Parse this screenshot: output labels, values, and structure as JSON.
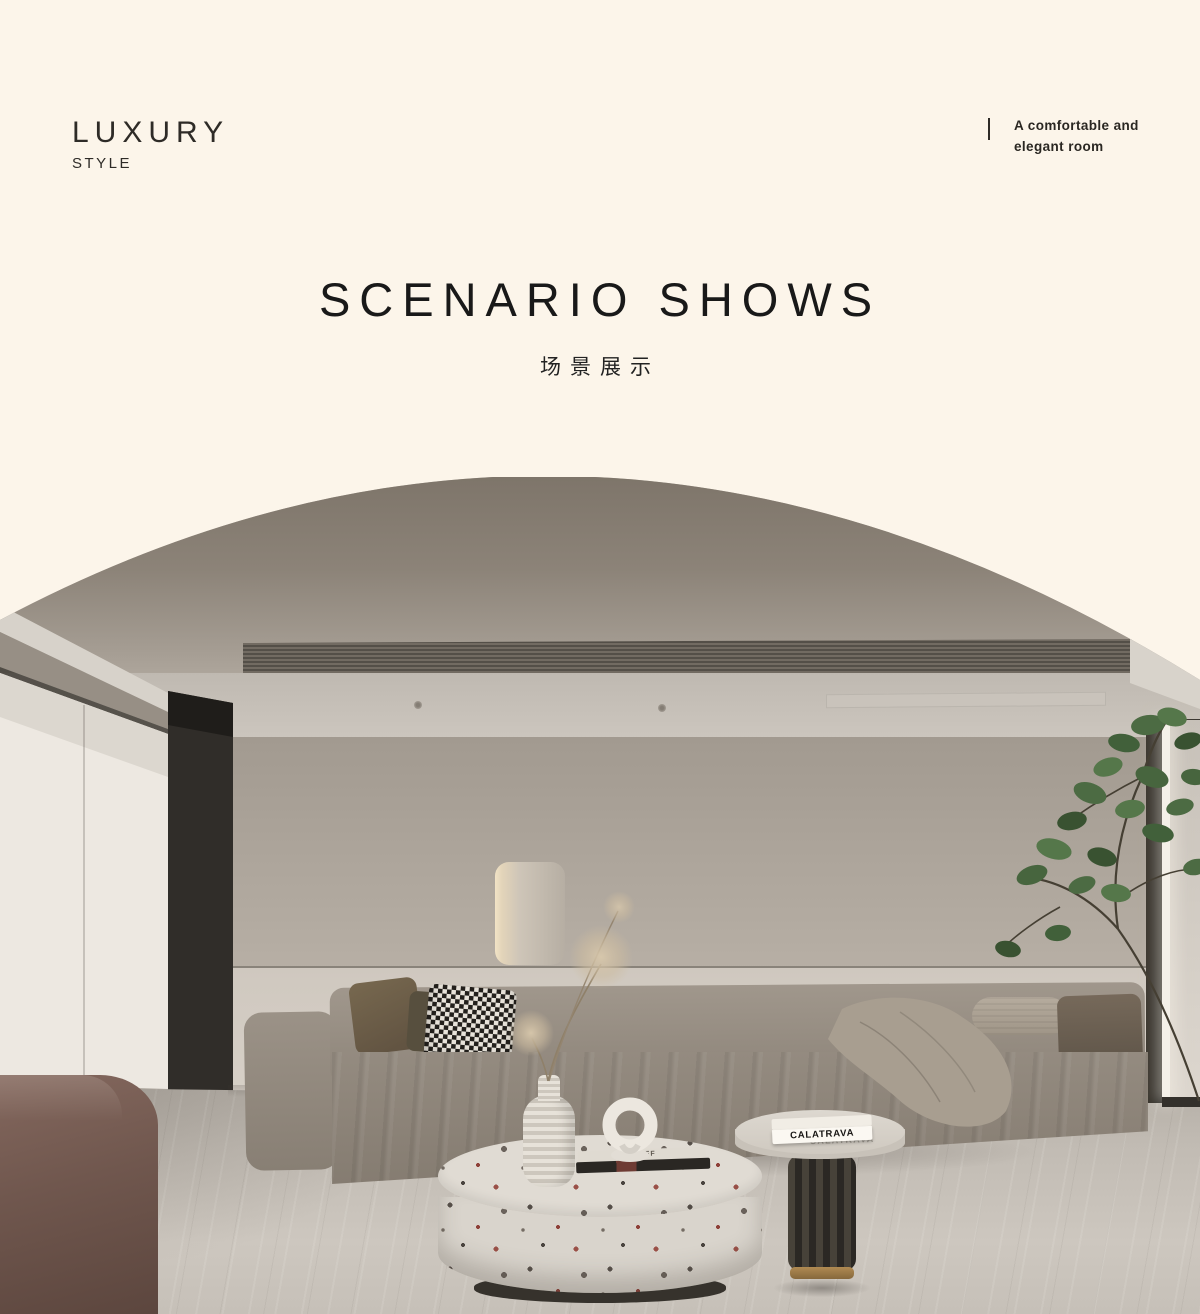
{
  "header": {
    "brand_title": "LUXURY",
    "brand_subtitle": "STYLE",
    "tagline": "A comfortable and elegant room"
  },
  "section": {
    "title": "SCENARIO SHOWS",
    "subtitle_cn": "场景展示"
  },
  "scene": {
    "book_title": "CALATRAVA",
    "book_small_title": "STOFF"
  },
  "colors": {
    "page_background": "#FCF5EA",
    "ink": "#2B2823",
    "ceiling": "#8C8378",
    "wall": "#AFA79D",
    "floor": "#C1BBB3",
    "sofa": "#958C81",
    "plant_green": "#4C6B43",
    "bench_brown": "#70574E"
  }
}
